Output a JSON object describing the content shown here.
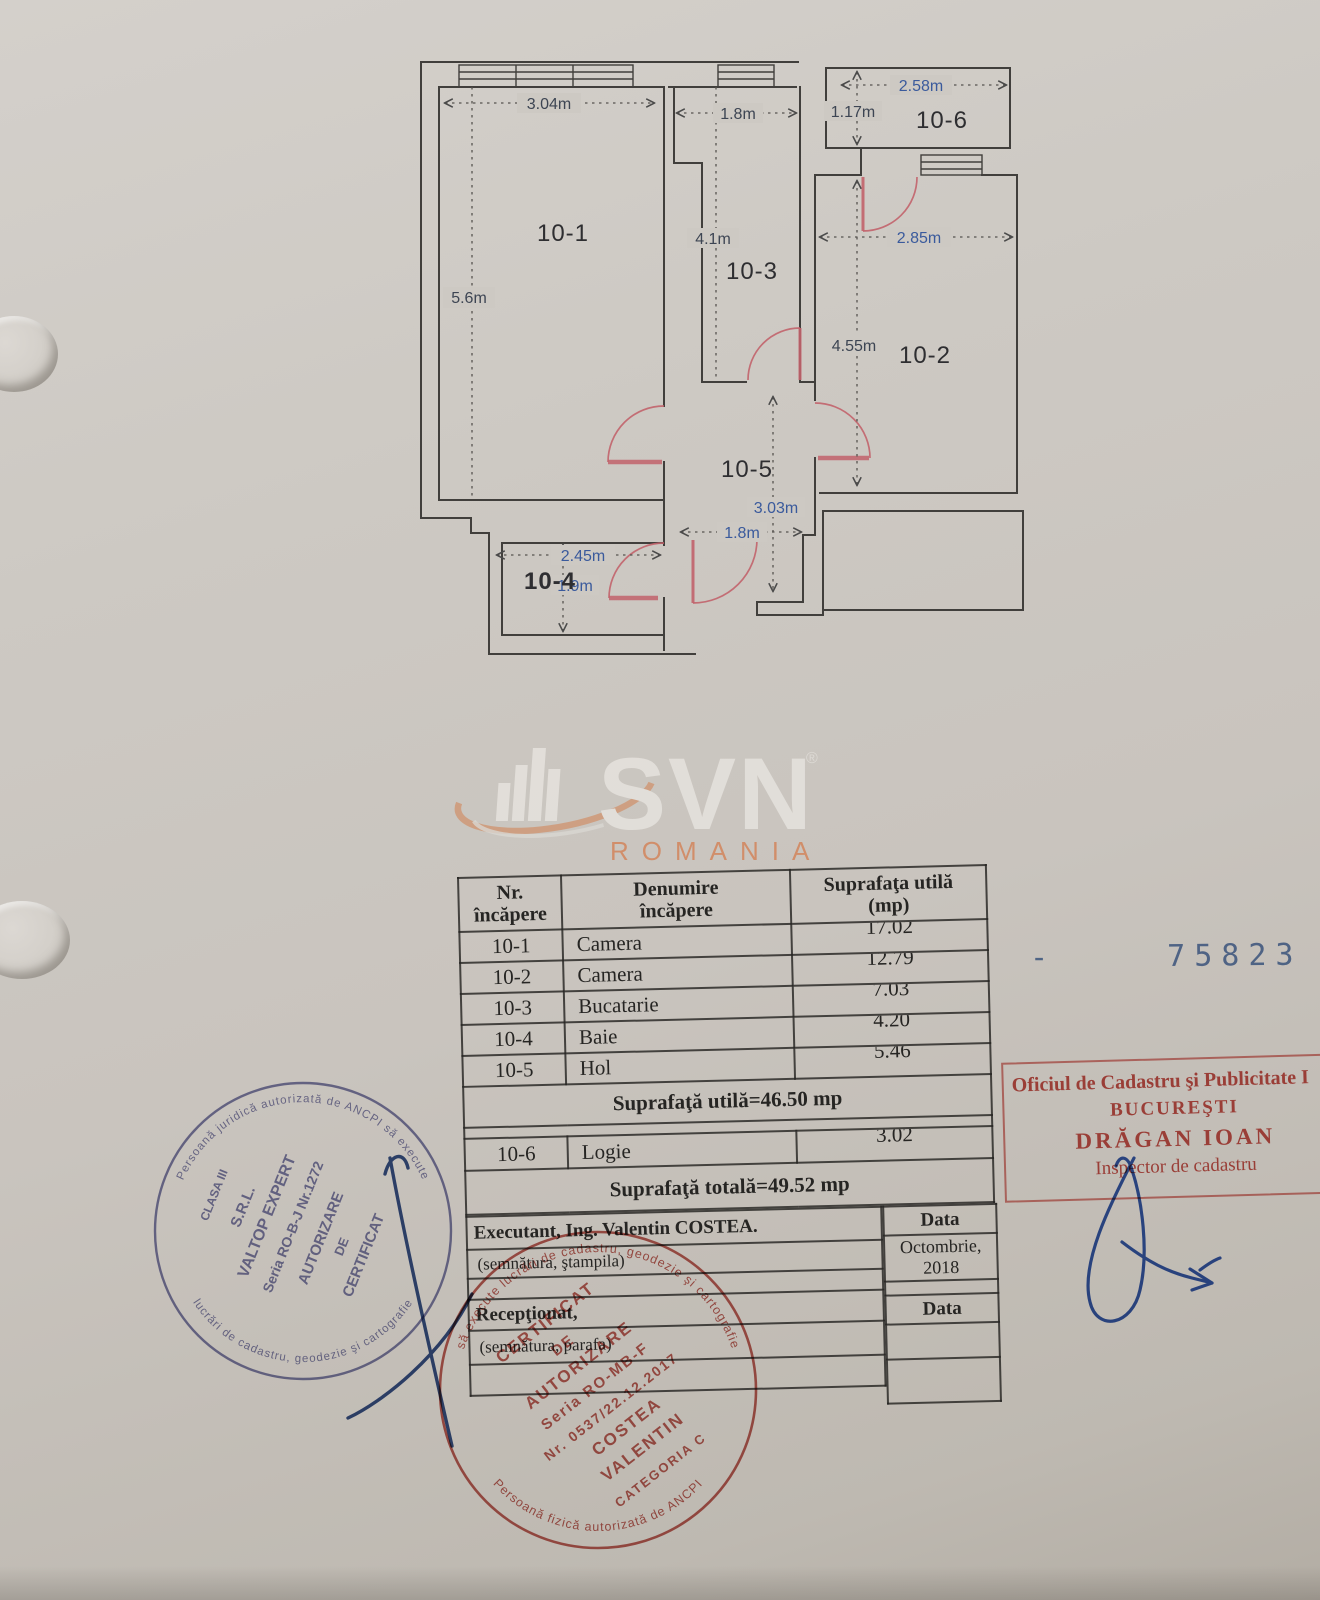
{
  "floor_plan": {
    "rooms": [
      {
        "id": "10-1",
        "width_label": "3.04m",
        "height_label": "5.6m"
      },
      {
        "id": "10-2",
        "width_label": "2.85m",
        "height_label": "4.55m"
      },
      {
        "id": "10-3",
        "width_label": "1.8m",
        "height_label": "4.1m"
      },
      {
        "id": "10-4",
        "width_label": "2.45m",
        "height_label": "1.9m"
      },
      {
        "id": "10-5",
        "width_label": "1.8m",
        "height_label": "3.03m"
      },
      {
        "id": "10-6",
        "width_label": "2.58m",
        "height_label": "1.17m"
      }
    ],
    "colors": {
      "wall_ink": "#413f3c",
      "door_arc": "#c2636c",
      "dim_blue": "#3a5a9c",
      "dim_dark": "#3d4553"
    }
  },
  "logo": {
    "brand": "SVN",
    "registered_mark": "®",
    "region": "ROMANIA",
    "brand_color": "#e4e1dc",
    "accent_color": "#d08a60"
  },
  "area_table": {
    "headers": {
      "col1_line1": "Nr.",
      "col1_line2": "încăpere",
      "col2_line1": "Denumire",
      "col2_line2": "încăpere",
      "col3_line1": "Suprafaţa utilă",
      "col3_line2": "(mp)"
    },
    "rows": [
      {
        "nr": "10-1",
        "denumire": "Camera",
        "suprafata": "17.02"
      },
      {
        "nr": "10-2",
        "denumire": "Camera",
        "suprafata": "12.79"
      },
      {
        "nr": "10-3",
        "denumire": "Bucatarie",
        "suprafata": "7.03"
      },
      {
        "nr": "10-4",
        "denumire": "Baie",
        "suprafata": "4.20"
      },
      {
        "nr": "10-5",
        "denumire": "Hol",
        "suprafata": "5.46"
      }
    ],
    "subtotal_row": "Suprafaţă utilă=46.50 mp",
    "logie_row": {
      "nr": "10-6",
      "denumire": "Logie",
      "suprafata": "3.02"
    },
    "total_row": "Suprafaţă totală=49.52 mp"
  },
  "signature_block": {
    "executant_label": "Executant, Ing. Valentin COSTEA.",
    "executant_note": "(semnătura, ştampila)",
    "receptionat_label": "Recepţionat,",
    "receptionat_note": "(semnătura, parafa)",
    "data_label_1": "Data",
    "data_value": "Octombrie, 2018",
    "data_label_2": "Data"
  },
  "registration_number": "-  75823  201",
  "stamps": {
    "office_stamp": {
      "line1": "Oficiul de Cadastru şi Publicitate I",
      "line2": "BUCUREŞTI",
      "line3": "DRĂGAN IOAN",
      "line4": "Inspector de cadastru",
      "color": "#c23b33"
    },
    "round_stamp_blue": {
      "ring_top": "Persoană juridică autorizată de ANCPI să execute",
      "ring_bottom": "lucrări de cadastru, geodezie şi cartografie",
      "line1": "CLASA III",
      "line2": "S.R.L.",
      "line3": "VALTOP EXPERT",
      "line4": "Seria RO-B-J Nr.1272",
      "line5": "AUTORIZARE",
      "line6": "DE",
      "line7": "CERTIFICAT",
      "color": "#5e5f99"
    },
    "round_stamp_red": {
      "ring_top": "să execute lucrări de cadastru, geodezie şi cartografie",
      "ring_bottom": "Persoană fizică autorizată de ANCPI",
      "line1": "CERTIFICAT",
      "line2": "DE",
      "line3": "AUTORIZARE",
      "line4": "Seria RO-MB-F",
      "line5": "Nr. 0537/22.12.2017",
      "line6": "COSTEA",
      "line7": "VALENTIN",
      "line8": "CATEGORIA C",
      "color": "#b5443c"
    }
  }
}
